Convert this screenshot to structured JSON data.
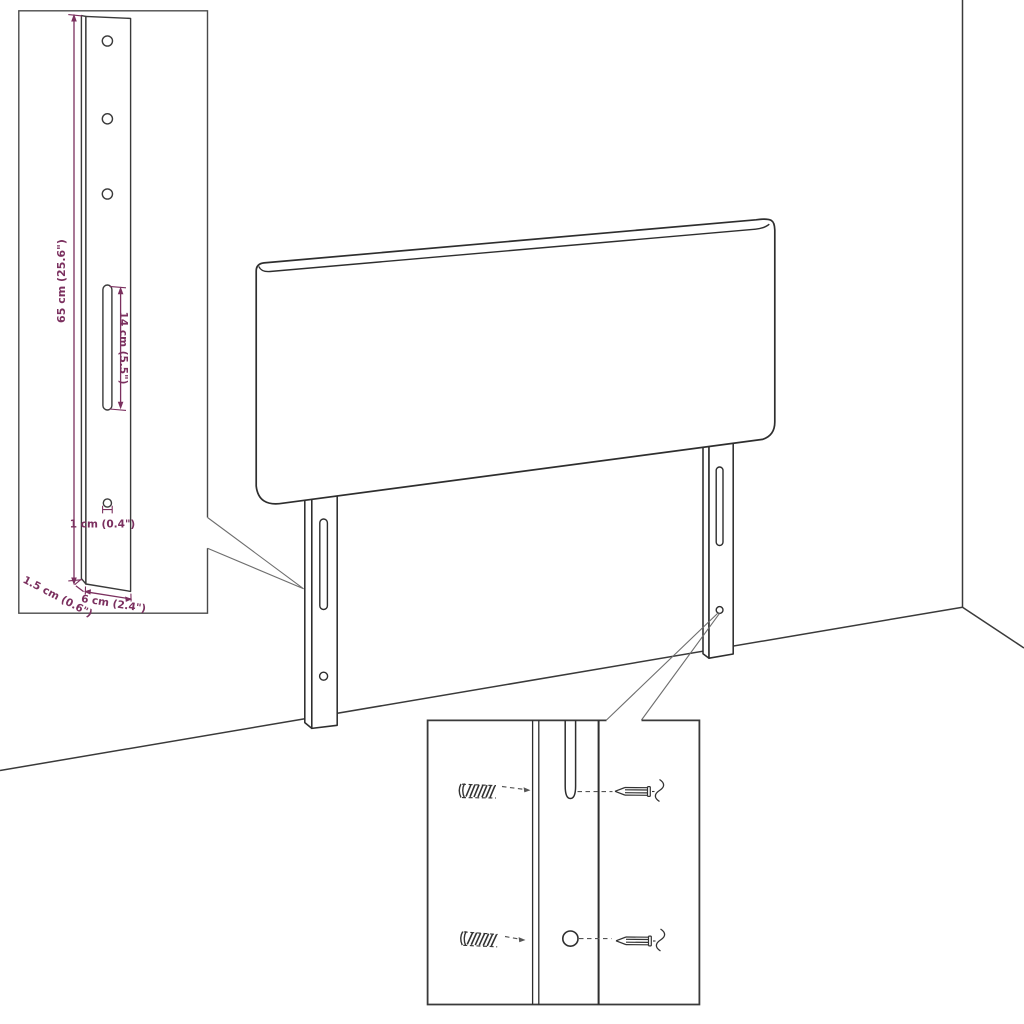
{
  "page": {
    "background": "#ffffff",
    "kind": "furniture dimension diagram",
    "subject": "headboard with two mounting legs"
  },
  "colors": {
    "line": "#2e2e2e",
    "accent_dimension": "#7b305f",
    "callout": "#6e6e6e",
    "inset_border": "#3a3a3a"
  },
  "inset_leg_detail": {
    "dim_height": "65 cm (25.6\")",
    "dim_slot_length": "14 cm (5.5\")",
    "dim_hole": "1 cm (0.4\")",
    "dim_thickness": "1.5 cm (0.6\")",
    "dim_width": "6 cm (2.4\")"
  }
}
